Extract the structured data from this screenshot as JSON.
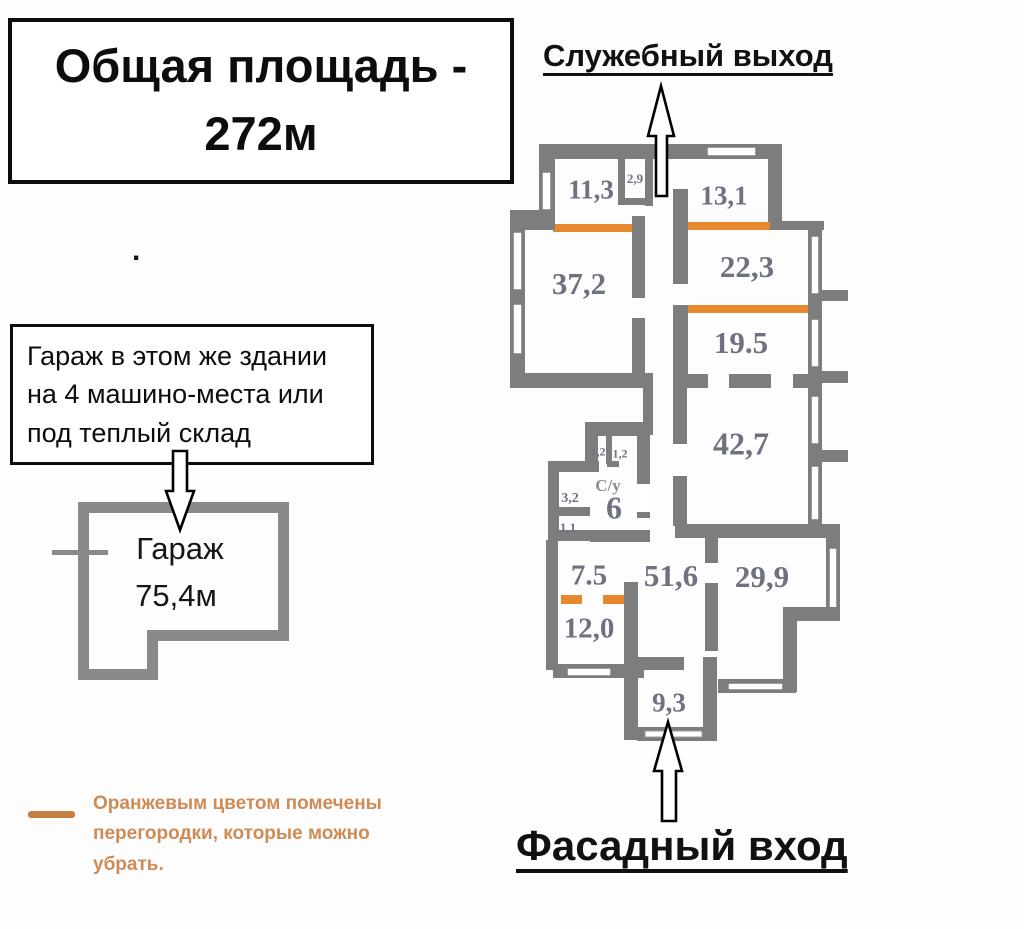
{
  "title_box": {
    "line1": "Общая площадь -",
    "line2": "272м"
  },
  "stray_dot": ".",
  "labels": {
    "service_exit": "Служебный выход",
    "facade_entrance": "Фасадный вход"
  },
  "garage_note": {
    "lines": [
      "Гараж в этом же здании",
      "на 4 машино-места или",
      "под теплый склад"
    ]
  },
  "garage": {
    "name": "Гараж",
    "area": "75,4м"
  },
  "legend": {
    "lines": [
      "Оранжевым цветом помечены",
      "перегородки, которые можно",
      "убрать."
    ],
    "swatch_color": "#c67e42"
  },
  "colors": {
    "wall": "#7d7d7d",
    "garage_wall": "#8a8a8a",
    "removable_partition": "#e8882e",
    "room_label": "#6e7280"
  },
  "plan": {
    "rooms": [
      {
        "id": "room-11-3",
        "area": "11,3"
      },
      {
        "id": "closet-2-9",
        "area": "2,9"
      },
      {
        "id": "room-13-1",
        "area": "13,1"
      },
      {
        "id": "room-37-2",
        "area": "37,2"
      },
      {
        "id": "room-22-3",
        "area": "22,3"
      },
      {
        "id": "room-19-5",
        "area": "19.5"
      },
      {
        "id": "room-42-7",
        "area": "42,7"
      },
      {
        "id": "wc-left",
        "area": "1,2"
      },
      {
        "id": "wc-right",
        "area": "1,2"
      },
      {
        "id": "bathroom",
        "area": "С/у"
      },
      {
        "id": "bathroom-area",
        "area": "6"
      },
      {
        "id": "room-3-2",
        "area": "3,2"
      },
      {
        "id": "room-1-1",
        "area": "1,1"
      },
      {
        "id": "room-7-5",
        "area": "7.5"
      },
      {
        "id": "hall-51-6",
        "area": "51,6"
      },
      {
        "id": "room-29-9",
        "area": "29,9"
      },
      {
        "id": "room-12-0",
        "area": "12,0"
      },
      {
        "id": "entry-9-3",
        "area": "9,3"
      }
    ]
  }
}
